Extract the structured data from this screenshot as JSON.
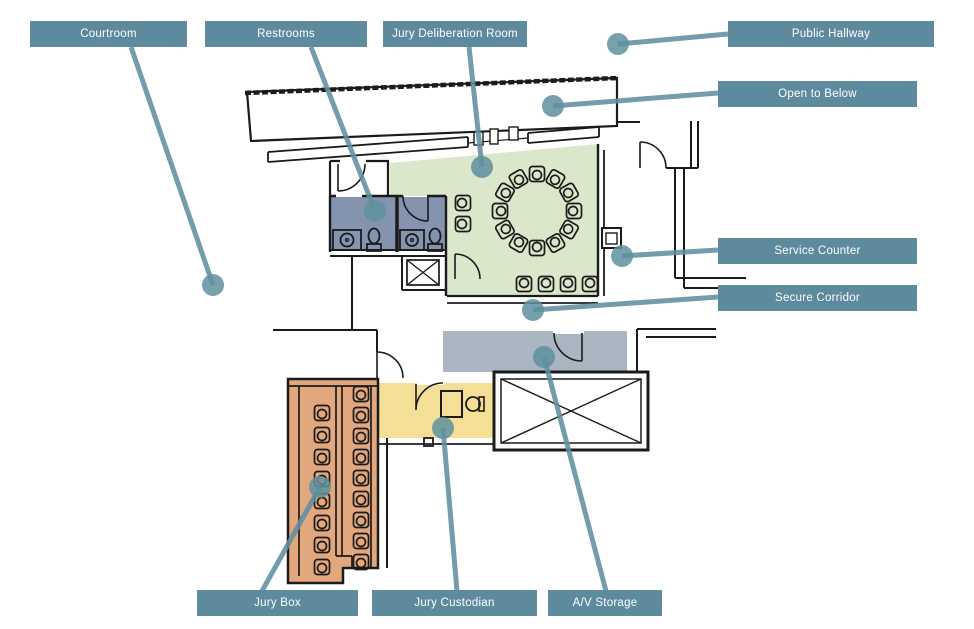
{
  "labels": {
    "courtroom": "Courtroom",
    "restrooms": "Restrooms",
    "jury_deliberation_room": "Jury Deliberation Room",
    "public_hallway": "Public Hallway",
    "open_to_below": "Open to Below",
    "service_counter": "Service Counter",
    "secure_corridor": "Secure Corridor",
    "jury_box": "Jury Box",
    "jury_custodian": "Jury Custodian",
    "av_storage": "A/V Storage"
  },
  "colors": {
    "callout_box": "#5d8b9d",
    "leader": "#60909f",
    "deliberation_room": "#dbe7ca",
    "restrooms": "#8494ae",
    "jury_box": "#e3a77e",
    "jury_custodian": "#f3df95",
    "av_storage": "#a9b5c1",
    "walls": "#1b1b1b"
  },
  "furniture": {
    "ring_chairs": 12,
    "row_chairs": 4,
    "wall_chairs": 2,
    "jury_box_left_chairs": 8,
    "jury_box_right_chairs": 9,
    "restroom_toilets": 2,
    "restroom_sinks": 2
  }
}
